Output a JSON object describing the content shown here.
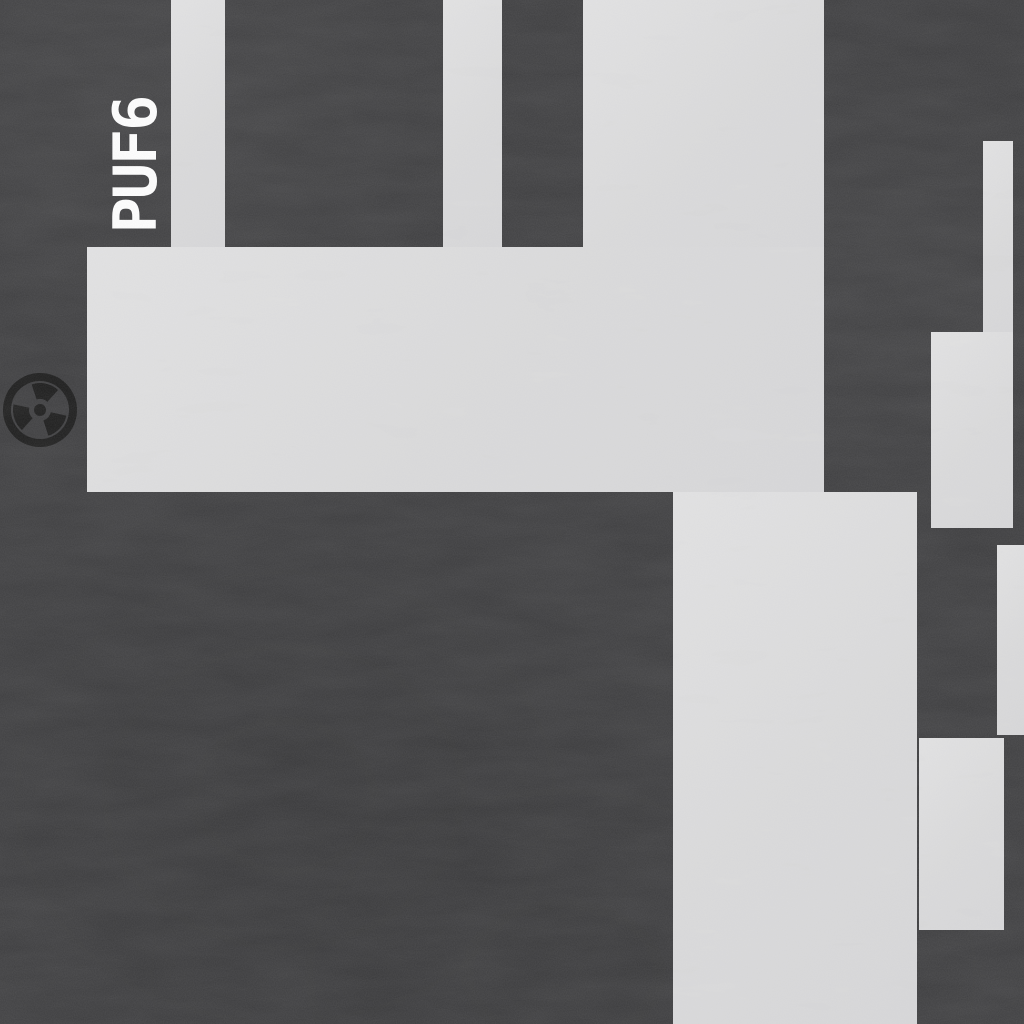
{
  "canvas": {
    "width": 1024,
    "height": 1024
  },
  "colors": {
    "background": "#3c3c3e",
    "floor": "#dcdcdd",
    "label": "#ffffff",
    "hazard_icon": "#1a1a1a"
  },
  "map": {
    "room_label": {
      "text": "PUF6",
      "rotation_deg": -90
    },
    "hazard_icon": {
      "name": "radiation-icon",
      "cx": 40,
      "cy": 410,
      "radius": 37
    },
    "rooms": [
      {
        "id": "north-strip-a",
        "x": 171,
        "y": 0,
        "w": 54,
        "h": 247
      },
      {
        "id": "north-strip-b",
        "x": 443,
        "y": 0,
        "w": 59,
        "h": 247
      },
      {
        "id": "north-block",
        "x": 583,
        "y": 0,
        "w": 241,
        "h": 247
      },
      {
        "id": "main-hall",
        "x": 87,
        "y": 247,
        "w": 737,
        "h": 245
      },
      {
        "id": "central-corridor",
        "x": 673,
        "y": 492,
        "w": 244,
        "h": 532
      },
      {
        "id": "east-strip-upper",
        "x": 983,
        "y": 141,
        "w": 30,
        "h": 191
      },
      {
        "id": "east-room-upper",
        "x": 931,
        "y": 332,
        "w": 82,
        "h": 196
      },
      {
        "id": "east-strip-lower",
        "x": 997,
        "y": 545,
        "w": 27,
        "h": 190
      },
      {
        "id": "east-room-lower",
        "x": 919,
        "y": 738,
        "w": 85,
        "h": 192
      }
    ]
  }
}
